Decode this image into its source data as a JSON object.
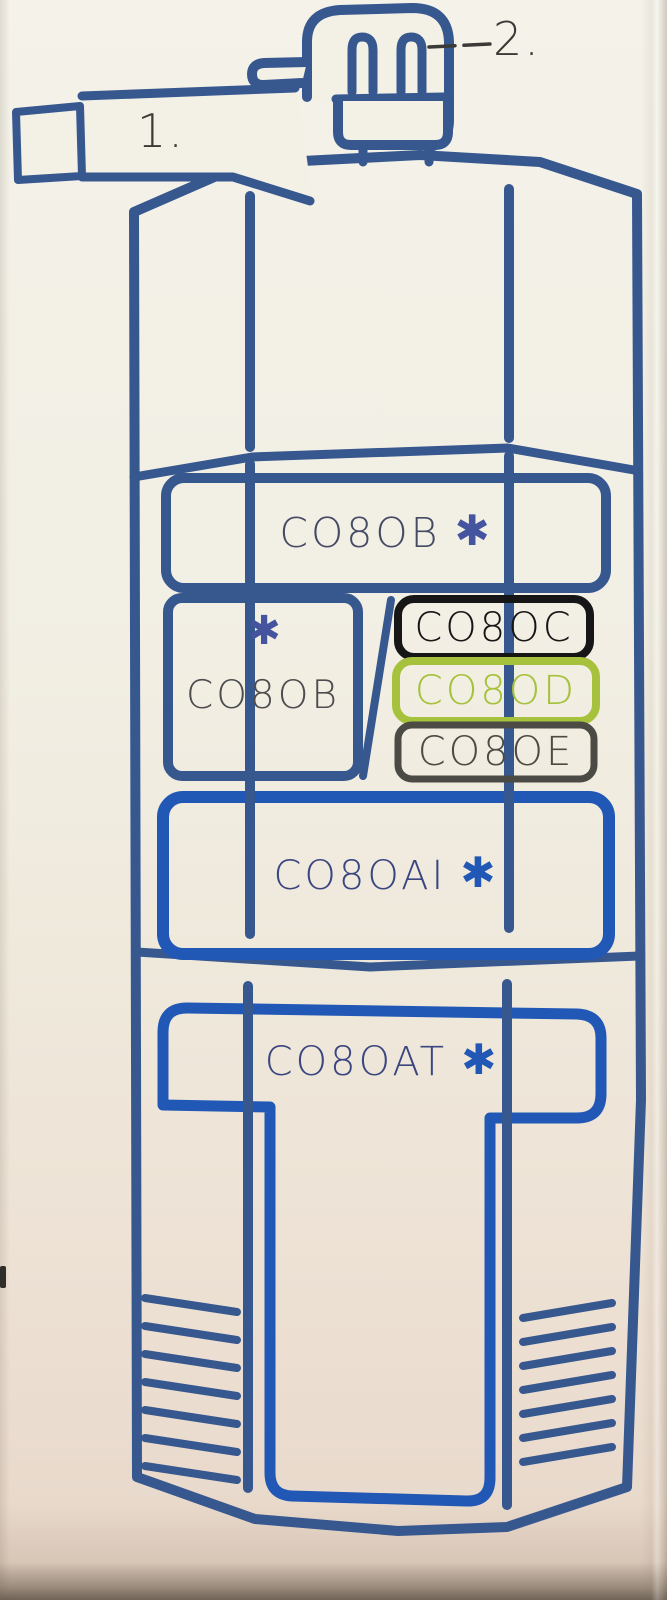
{
  "diagram": {
    "description": "Coffee grinder exploded parts diagram printed on packaging",
    "callouts": {
      "handle": "1.",
      "plug": "2."
    },
    "labels": {
      "hopper_wide": {
        "text": "CO8OB",
        "asterisk": "✱"
      },
      "hopper_square": {
        "text": "CO8OB",
        "asterisk": "✱"
      },
      "variant_c": {
        "text": "CO8OC"
      },
      "variant_d": {
        "text": "CO8OD"
      },
      "variant_e": {
        "text": "CO8OE"
      },
      "mid_body": {
        "text": "CO8OAI",
        "asterisk": "✱"
      },
      "base_body": {
        "text": "CO8OAT",
        "asterisk": "✱"
      }
    },
    "colors": {
      "outline_navy": "#37578f",
      "accent_blue": "#2158b6",
      "variant_c_black": "#161616",
      "variant_d_green": "#a6c13c",
      "variant_e_gray": "#4b4a44",
      "ink_dark": "#454b63",
      "ink_gray": "#4d4d4f",
      "ink_blue_text": "#3b4680",
      "asterisk_navy": "#44549e",
      "callout_ink": "#3b3a36",
      "paper": "#f3f0e6"
    }
  }
}
